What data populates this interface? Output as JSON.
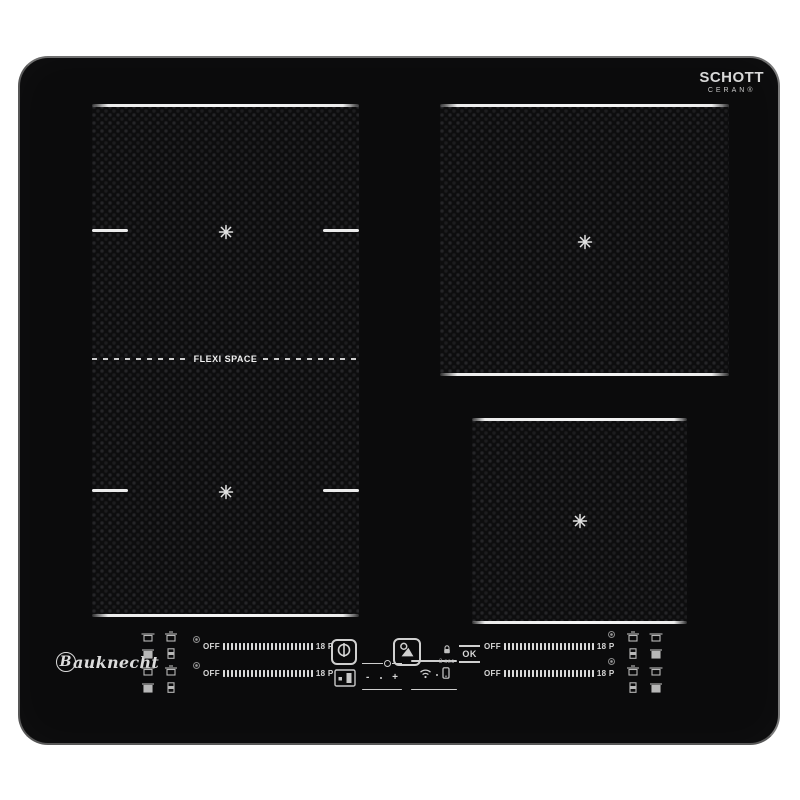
{
  "branding": {
    "schott": "SCHOTT",
    "ceran": "CERAN®",
    "bauknecht_initial": "B",
    "bauknecht_rest": "auknecht"
  },
  "zones": {
    "flexi_label": "FLEXI SPACE",
    "pan_symbol_icon": "eight-spoke-asterisk-icon",
    "zone_names": [
      "flexi-zone-upper-left",
      "flexi-zone-lower-left",
      "zone-upper-right",
      "zone-lower-right"
    ]
  },
  "controls": {
    "slider_off_label": "OFF",
    "slider_max_label": "18 P",
    "slider_tick_count": 23,
    "hold_label": "3 sec",
    "ok_label": "OK",
    "minus_label": "-",
    "plus_label": "+",
    "power_icon": "power-icon",
    "lock_display_icon": "lock-display-icon",
    "auto_functions_icon": "auto-functions-icon",
    "hold_lock_icon": "padlock-icon",
    "wifi_icon": "wifi-icon",
    "remote_icon": "smartphone-icon",
    "cookware_left": [
      [
        "saucepan-icon",
        "pot-lid-icon"
      ],
      [
        "pot-filled-icon",
        "canister-icon"
      ],
      [
        "saucepan-icon",
        "pot-lid-icon"
      ],
      [
        "pot-filled-icon",
        "canister-icon"
      ]
    ],
    "cookware_right": [
      [
        "pot-lid-icon",
        "saucepan-icon"
      ],
      [
        "canister-icon",
        "pot-filled-icon"
      ],
      [
        "pot-lid-icon",
        "saucepan-icon"
      ],
      [
        "canister-icon",
        "pot-filled-icon"
      ]
    ]
  },
  "colors": {
    "background": "#ffffff",
    "glass": "#0b0b0c",
    "zone_line": "#ececec",
    "panel_text": "#d9d9d9",
    "icon_gray": "#c8c8c8"
  }
}
